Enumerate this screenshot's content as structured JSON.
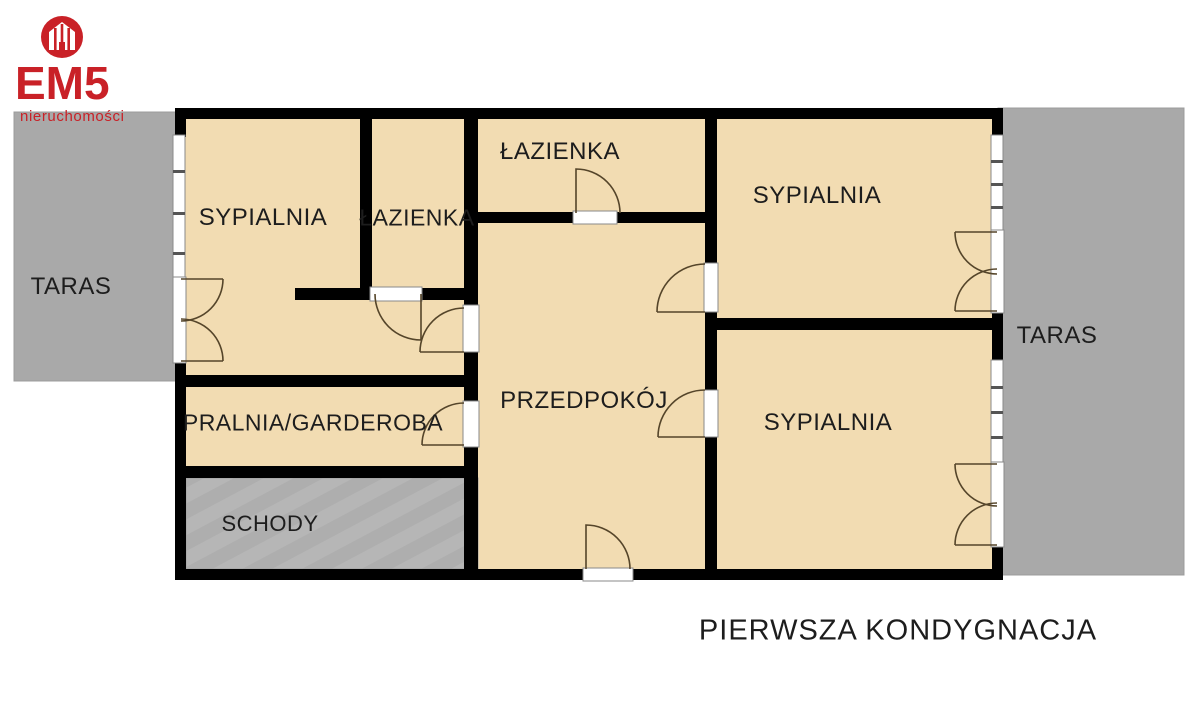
{
  "logo": {
    "brand": "EM5",
    "tagline": "nieruchomości"
  },
  "floorplan": {
    "caption": "PIERWSZA KONDYGNACJA",
    "rooms": {
      "bedroom_left": "SYPIALNIA",
      "bathroom_left": "ŁAZIENKA",
      "bathroom_top": "ŁAZIENKA",
      "bedroom_top_right": "SYPIALNIA",
      "bedroom_bottom_right": "SYPIALNIA",
      "hallway": "PRZEDPOKÓJ",
      "laundry": "PRALNIA/GARDEROBA",
      "stairs": "SCHODY",
      "terrace_left": "TARAS",
      "terrace_right": "TARAS"
    }
  },
  "colors": {
    "brand_red": "#c92127",
    "room_fill": "#f2dcb2",
    "wall": "#000000",
    "terrace_gray": "#a9a9a9",
    "stairs_gray": "#b5b5b5",
    "door_arc": "#55452a",
    "label_text": "#1d1d1d"
  }
}
